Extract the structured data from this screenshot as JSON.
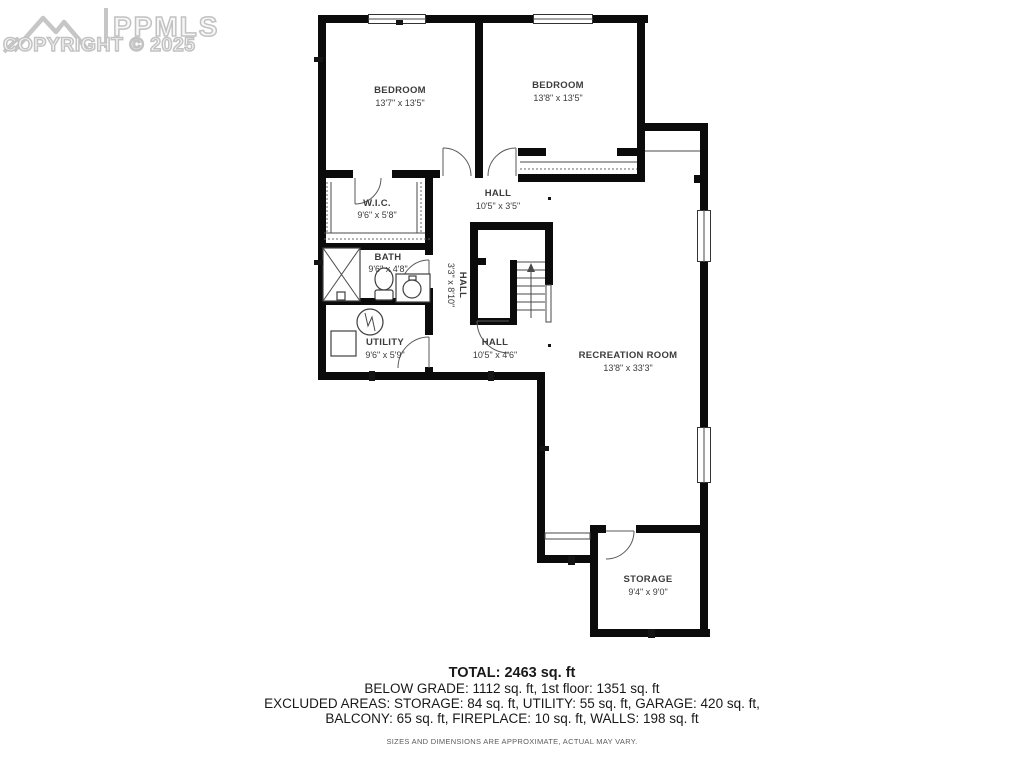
{
  "watermark": {
    "brand": "PPMLS",
    "copyright": "COPYRIGHT © 2025"
  },
  "rooms": {
    "bedroom1": {
      "name": "BEDROOM",
      "dims": "13'7\" x 13'5\""
    },
    "bedroom2": {
      "name": "BEDROOM",
      "dims": "13'8\" x 13'5\""
    },
    "wic": {
      "name": "W.I.C.",
      "dims": "9'6\" x 5'8\""
    },
    "hall_top": {
      "name": "HALL",
      "dims": "10'5\" x 3'5\""
    },
    "bath": {
      "name": "BATH",
      "dims": "9'6\" x 4'8\""
    },
    "hall_vertical": {
      "name": "HALL",
      "dims": "3'3\" x 8'10\""
    },
    "utility": {
      "name": "UTILITY",
      "dims": "9'6\" x 5'9\""
    },
    "hall_lower": {
      "name": "HALL",
      "dims": "10'5\" x 4'6\""
    },
    "recreation": {
      "name": "RECREATION ROOM",
      "dims": "13'8\" x 33'3\""
    },
    "storage": {
      "name": "STORAGE",
      "dims": "9'4\" x 9'0\""
    }
  },
  "summary": {
    "total": "TOTAL: 2463 sq. ft",
    "line1": "BELOW GRADE: 1112 sq. ft, 1st floor: 1351 sq. ft",
    "line2": "EXCLUDED AREAS: STORAGE: 84 sq. ft, UTILITY: 55 sq. ft, GARAGE: 420 sq. ft,",
    "line3": "BALCONY: 65 sq. ft, FIREPLACE: 10 sq. ft, WALLS: 198 sq. ft",
    "disclaimer": "SIZES AND DIMENSIONS ARE APPROXIMATE, ACTUAL MAY VARY."
  },
  "colors": {
    "wall": "#0b0b0b",
    "label": "#3c3c3c",
    "watermark_gray": "#c2c2c2"
  }
}
